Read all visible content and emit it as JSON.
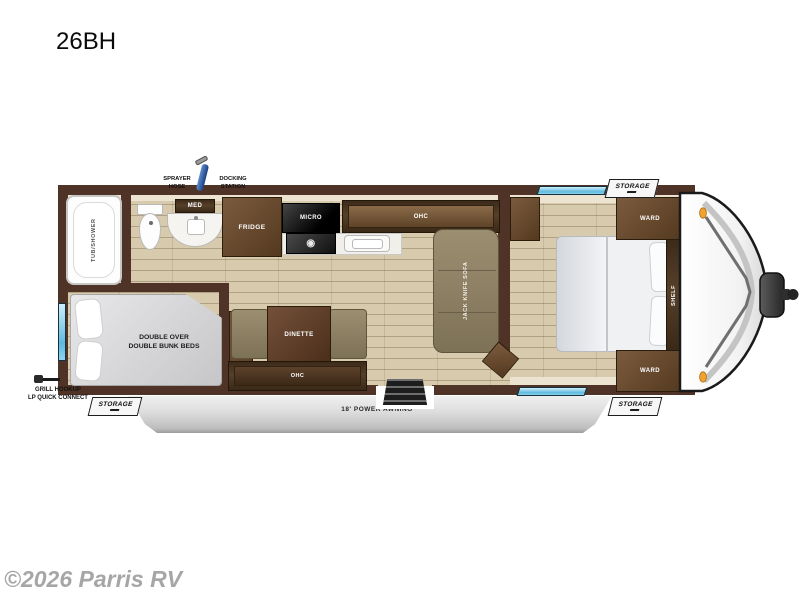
{
  "title": "26BH",
  "watermark": "©2026 Parris RV",
  "colors": {
    "wall": "#4e3326",
    "wood_dark": "#3c2a1a",
    "wood": "#7b5b3e",
    "floor": "#d8cbad",
    "cushion": "#9c8e71",
    "awning_gray": "#d6d6d6",
    "window_blue": "#5fb9de",
    "marker_light": "#f2a22e"
  },
  "icons": {
    "burner": "◉"
  },
  "callouts": {
    "sprayer_hose": [
      "SPRAYER",
      "HOSE"
    ],
    "docking_station": [
      "DOCKING",
      "STATION"
    ],
    "grill_hookup": [
      "GRILL HOOKUP",
      "LP QUICK CONNECT"
    ],
    "awning": "18' POWER AWNING",
    "storage_rear": "STORAGE",
    "storage_front_top": "STORAGE",
    "storage_front_bottom": "STORAGE"
  },
  "rooms": {
    "bathroom": {
      "tub_shower": "TUB/SHOWER",
      "med_cabinet": "MED"
    },
    "kitchen": {
      "fridge": "FRIDGE",
      "microwave": "MICRO",
      "overhead_cabinet": "OHC"
    },
    "living": {
      "sofa": "JACK KNIFE SOFA",
      "dinette": "DINETTE",
      "dinette_overhead_cabinet": "OHC",
      "bunk_line1": "DOUBLE OVER",
      "bunk_line2": "DOUBLE BUNK BEDS"
    },
    "bedroom": {
      "wardrobe_top": "WARD",
      "wardrobe_bottom": "WARD",
      "shelf": "SHELF"
    }
  }
}
